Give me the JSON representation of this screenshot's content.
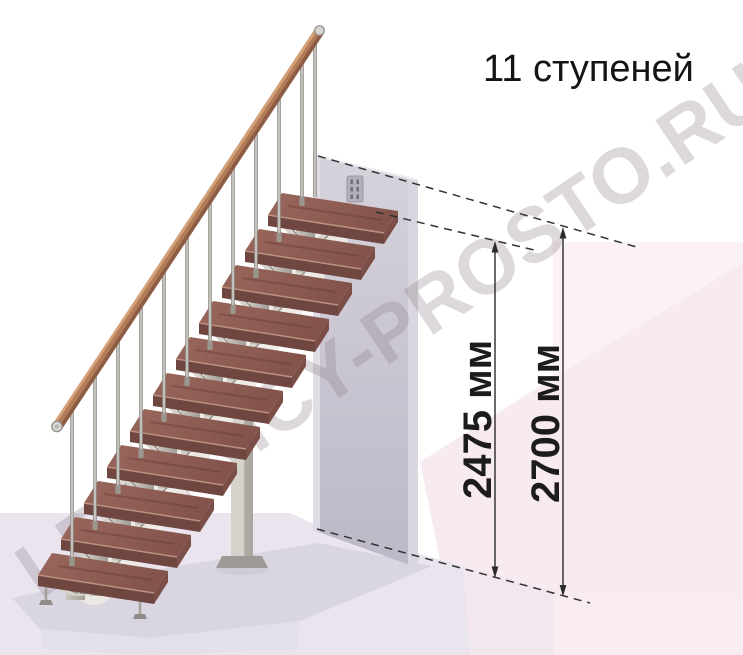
{
  "title": "11 ступеней",
  "watermark": "LESTNICY-PROSTO.RU",
  "dimensions": {
    "stair_height": "2475 мм",
    "ceiling_height": "2700 мм"
  },
  "stairs": {
    "steps_count": 11,
    "tread_top_color": "#8d5b52",
    "tread_top_light": "#9c685d",
    "tread_front_color": "#6f4640",
    "tread_end_color": "#7b4f48",
    "tread_edge_highlight": "#bb9181",
    "rail_color": "#b27c59",
    "baluster_color": "#cac7c2",
    "baluster_edge_color": "#8f8c87",
    "bracket_slat_light": "#c9c6bf",
    "bracket_slat_dark": "#a09d96",
    "bracket_arm_color": "#d7d4cd",
    "bracket_arm_dark": "#98958f",
    "bracket_blob_color": "#edebe4",
    "wall_color": "#c9c5d2",
    "floor_color": "#e9e4ee",
    "slab_color": "#d9d6e1",
    "pink_wall_color": "#f7eaf1",
    "dimension_color": "#1c1c1c"
  }
}
